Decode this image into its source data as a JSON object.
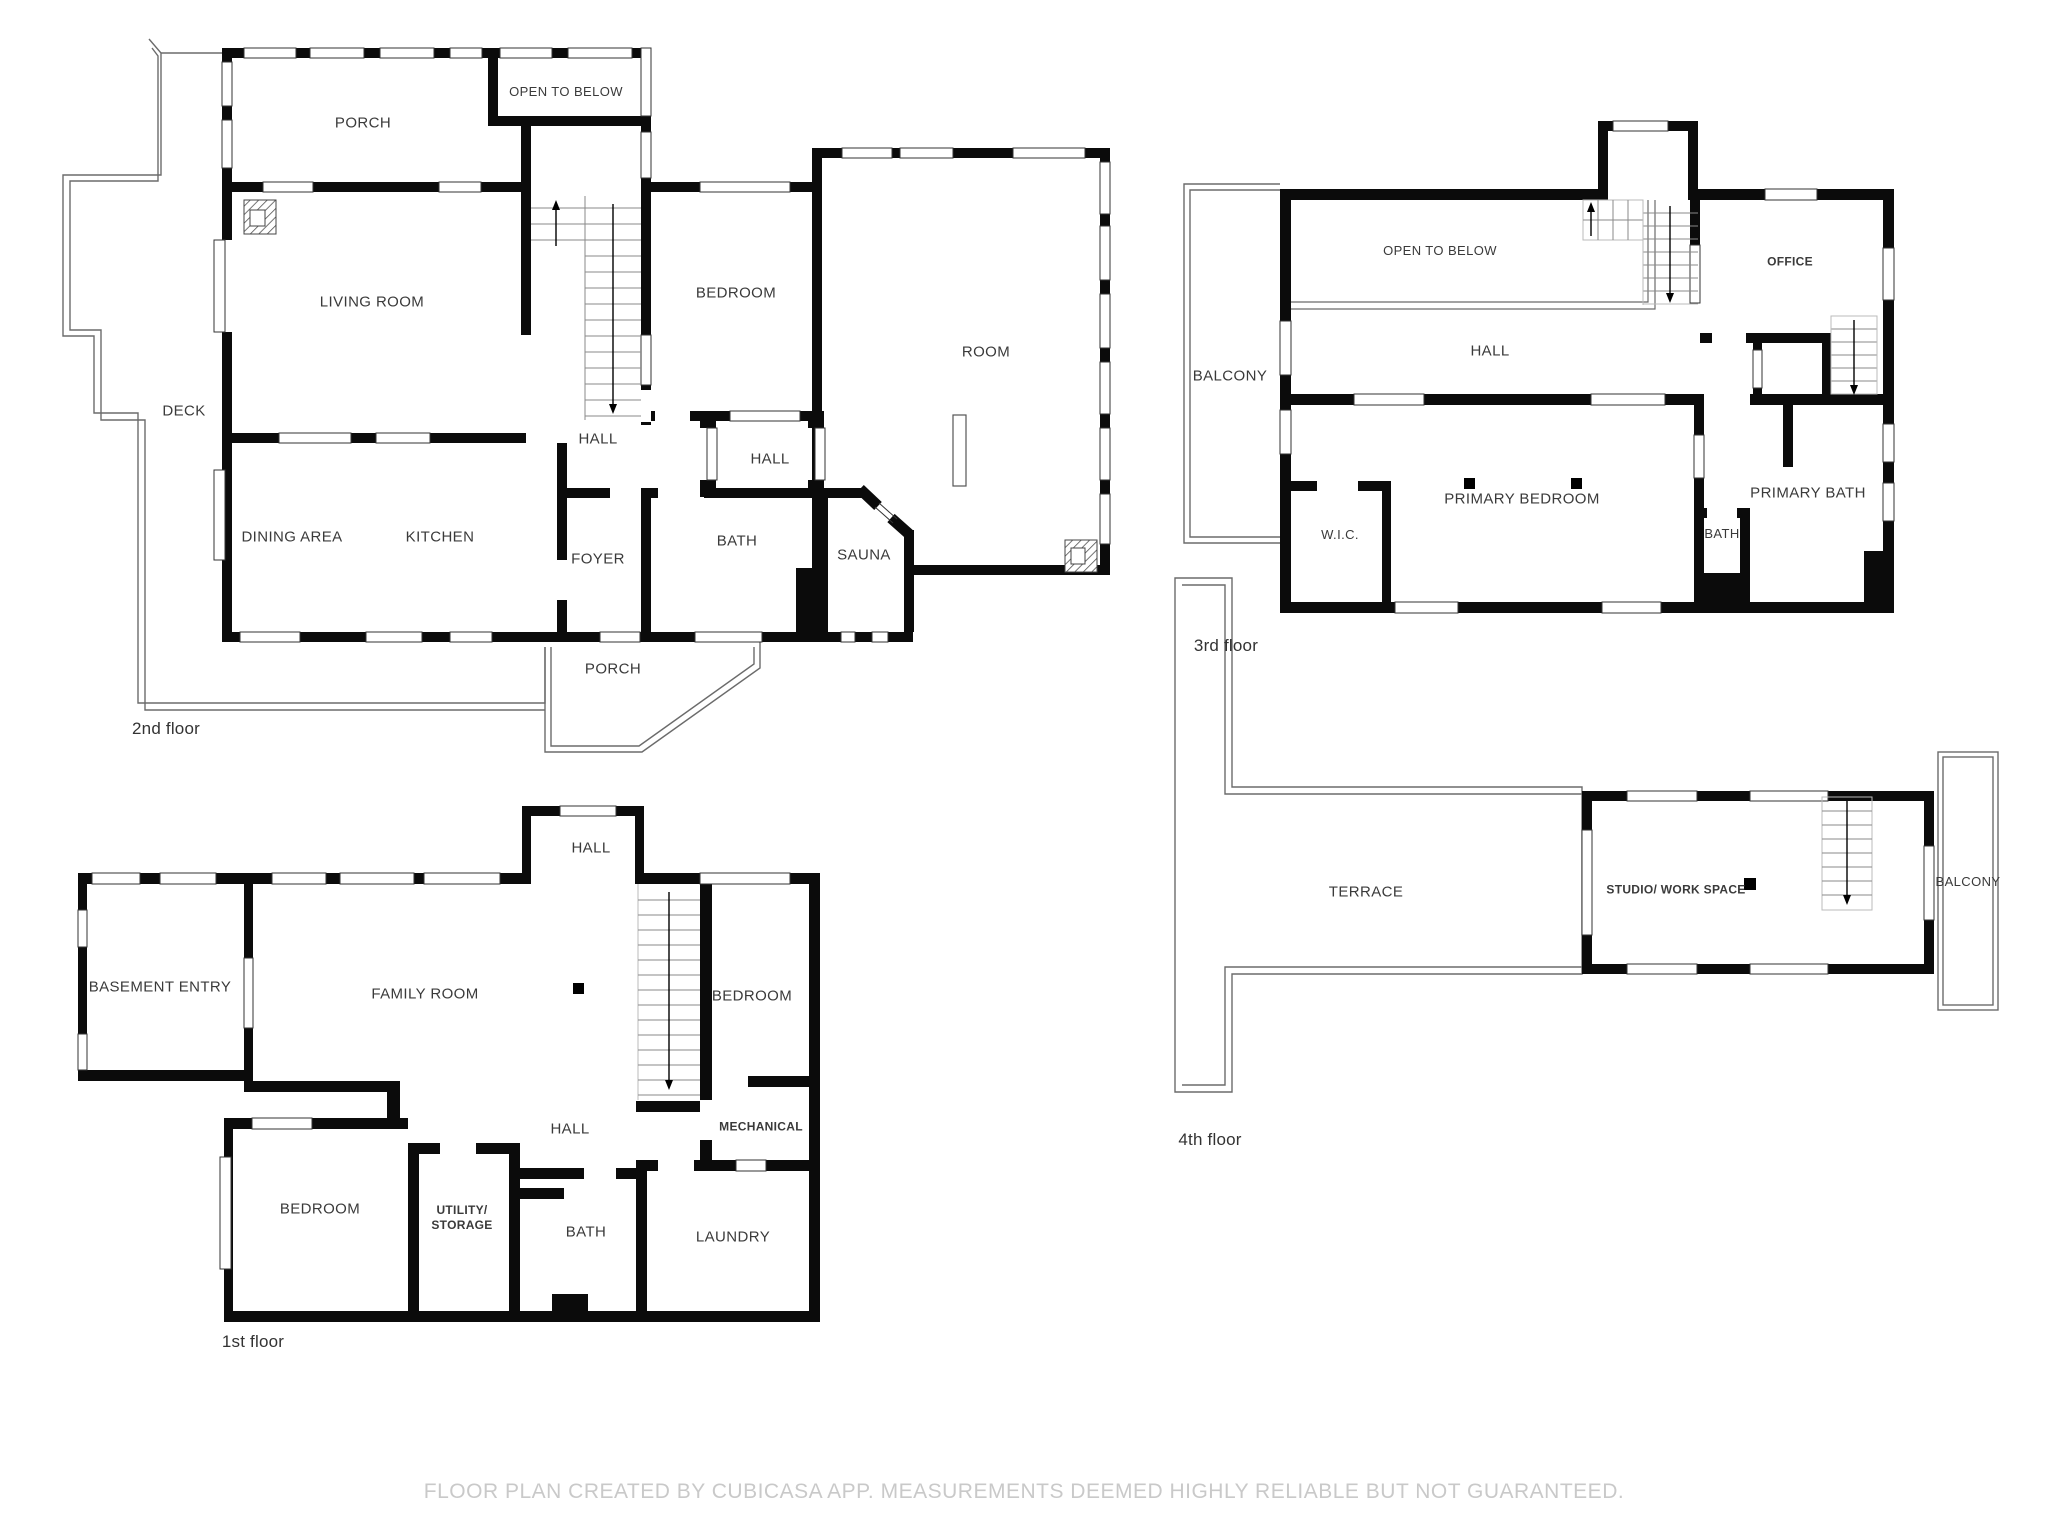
{
  "footer": {
    "text": "FLOOR PLAN CREATED BY CUBICASA APP. MEASUREMENTS DEEMED HIGHLY RELIABLE BUT NOT GUARANTEED."
  },
  "colors": {
    "wall": "#0b0b0b",
    "thin_outline": "#6b6b6b",
    "label": "#3a3a3a",
    "footer": "#c9c9c9"
  },
  "floors": [
    {
      "id": "2nd",
      "name": "2nd floor",
      "rooms": [
        {
          "label": "PORCH"
        },
        {
          "label": "OPEN TO BELOW"
        },
        {
          "label": "LIVING ROOM"
        },
        {
          "label": "DECK"
        },
        {
          "label": "BEDROOM"
        },
        {
          "label": "ROOM"
        },
        {
          "label": "HALL"
        },
        {
          "label": "HALL"
        },
        {
          "label": "DINING AREA"
        },
        {
          "label": "KITCHEN"
        },
        {
          "label": "FOYER"
        },
        {
          "label": "BATH"
        },
        {
          "label": "SAUNA"
        },
        {
          "label": "PORCH"
        }
      ]
    },
    {
      "id": "3rd",
      "name": "3rd floor",
      "rooms": [
        {
          "label": "BALCONY"
        },
        {
          "label": "OPEN TO BELOW"
        },
        {
          "label": "HALL"
        },
        {
          "label": "OFFICE"
        },
        {
          "label": "W.I.C."
        },
        {
          "label": "PRIMARY BEDROOM"
        },
        {
          "label": "BATH"
        },
        {
          "label": "PRIMARY BATH"
        }
      ]
    },
    {
      "id": "1st",
      "name": "1st floor",
      "rooms": [
        {
          "label": "HALL"
        },
        {
          "label": "BASEMENT ENTRY"
        },
        {
          "label": "FAMILY ROOM"
        },
        {
          "label": "BEDROOM"
        },
        {
          "label": "HALL"
        },
        {
          "label": "MECHANICAL"
        },
        {
          "label": "BEDROOM"
        },
        {
          "label": "UTILITY/\nSTORAGE"
        },
        {
          "label": "BATH"
        },
        {
          "label": "LAUNDRY"
        }
      ]
    },
    {
      "id": "4th",
      "name": "4th floor",
      "rooms": [
        {
          "label": "TERRACE"
        },
        {
          "label": "STUDIO/ WORK SPACE"
        },
        {
          "label": "BALCONY"
        }
      ]
    }
  ]
}
